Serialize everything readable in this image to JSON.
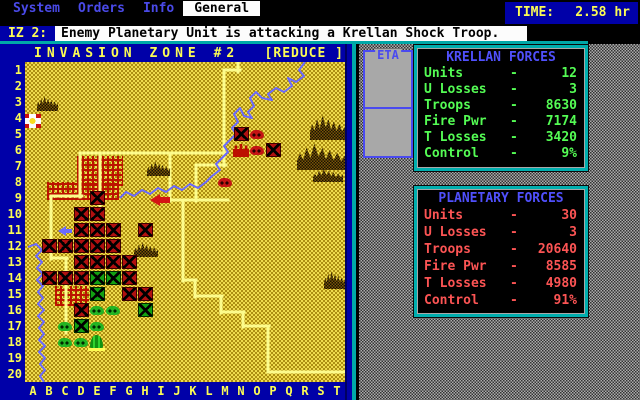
{
  "palette": {
    "blue": "#0000A8",
    "light_blue": "#5050FC",
    "teal": "#00A8A8",
    "yellow": "#FCFC54",
    "green": "#54FC54",
    "red": "#FC5454",
    "white": "#FCFCFC",
    "gray": "#A8A8A8"
  },
  "menu": {
    "items": [
      "System",
      "Orders",
      "Info",
      "General"
    ],
    "active": "General",
    "time_label": "TIME:",
    "time_value": "2.58 hr"
  },
  "message": {
    "prefix": "IZ 2:",
    "text": "Enemy Planetary Unit is attacking a Krellan Shock Troop."
  },
  "eta": {
    "label": "ETA"
  },
  "map": {
    "title": "INVASION ZONE #2",
    "reduce_button": "[REDUCE ]",
    "row_count": 20,
    "col_letters": "ABCDEFGHIJKLMNOPQRST",
    "features": {
      "cities": [
        [
          52,
          94,
          46,
          30
        ],
        [
          22,
          120,
          72,
          18
        ],
        [
          30,
          224,
          34,
          20
        ]
      ],
      "mountains": [
        [
          12,
          31,
          21,
          18
        ],
        [
          122,
          96,
          23,
          18
        ],
        [
          285,
          48,
          35,
          30
        ],
        [
          272,
          76,
          48,
          32
        ],
        [
          288,
          104,
          30,
          16
        ],
        [
          109,
          177,
          24,
          18
        ],
        [
          299,
          205,
          21,
          22
        ]
      ],
      "roads": [
        [
          213,
          0,
          213,
          10
        ],
        [
          199,
          8,
          215,
          8
        ],
        [
          199,
          8,
          199,
          104
        ],
        [
          55,
          91,
          201,
          91
        ],
        [
          145,
          91,
          145,
          139
        ],
        [
          171,
          103,
          201,
          103
        ],
        [
          171,
          103,
          171,
          139
        ],
        [
          135,
          138,
          203,
          138
        ],
        [
          158,
          138,
          158,
          219
        ],
        [
          55,
          91,
          55,
          135
        ],
        [
          75,
          91,
          75,
          144
        ],
        [
          27,
          134,
          57,
          134
        ],
        [
          26,
          134,
          26,
          197
        ],
        [
          26,
          196,
          42,
          196
        ],
        [
          41,
          196,
          41,
          271
        ],
        [
          158,
          218,
          171,
          218
        ],
        [
          170,
          218,
          170,
          235
        ],
        [
          170,
          234,
          197,
          234
        ],
        [
          196,
          234,
          196,
          251
        ],
        [
          196,
          250,
          219,
          250
        ],
        [
          218,
          250,
          218,
          265
        ],
        [
          218,
          264,
          244,
          264
        ],
        [
          243,
          264,
          243,
          310
        ],
        [
          243,
          310,
          320,
          310
        ]
      ],
      "rivers": [
        [
          [
            280,
            0
          ],
          [
            274,
            8
          ],
          [
            279,
            14
          ],
          [
            271,
            20
          ],
          [
            263,
            16
          ],
          [
            267,
            24
          ],
          [
            259,
            30
          ],
          [
            251,
            26
          ],
          [
            243,
            32
          ],
          [
            247,
            38
          ],
          [
            237,
            36
          ],
          [
            231,
            30
          ],
          [
            225,
            36
          ],
          [
            229,
            44
          ],
          [
            223,
            50
          ],
          [
            227,
            56
          ],
          [
            219,
            54
          ],
          [
            215,
            46
          ],
          [
            209,
            52
          ],
          [
            213,
            60
          ],
          [
            207,
            66
          ],
          [
            211,
            72
          ],
          [
            205,
            78
          ],
          [
            199,
            84
          ],
          [
            203,
            90
          ],
          [
            197,
            96
          ],
          [
            191,
            102
          ],
          [
            195,
            108
          ],
          [
            187,
            114
          ],
          [
            181,
            120
          ],
          [
            173,
            126
          ],
          [
            165,
            122
          ],
          [
            157,
            128
          ],
          [
            149,
            124
          ],
          [
            141,
            130
          ],
          [
            133,
            126
          ],
          [
            125,
            132
          ],
          [
            117,
            128
          ],
          [
            109,
            134
          ],
          [
            101,
            130
          ],
          [
            95,
            136
          ]
        ],
        [
          [
            3,
            185
          ],
          [
            11,
            182
          ],
          [
            17,
            188
          ],
          [
            11,
            194
          ],
          [
            17,
            200
          ],
          [
            12,
            206
          ],
          [
            18,
            212
          ],
          [
            12,
            218
          ],
          [
            18,
            224
          ],
          [
            13,
            230
          ],
          [
            18,
            236
          ],
          [
            13,
            242
          ],
          [
            19,
            248
          ],
          [
            13,
            254
          ],
          [
            19,
            260
          ],
          [
            14,
            266
          ],
          [
            19,
            272
          ],
          [
            14,
            278
          ],
          [
            20,
            284
          ],
          [
            14,
            290
          ],
          [
            20,
            296
          ],
          [
            15,
            302
          ],
          [
            20,
            308
          ],
          [
            15,
            314
          ],
          [
            19,
            320
          ]
        ]
      ],
      "units": [
        [
          "A",
          4,
          "flag"
        ],
        [
          "N",
          5,
          "red-square"
        ],
        [
          "O",
          5,
          "red-tank"
        ],
        [
          "N",
          6,
          "fort"
        ],
        [
          "O",
          6,
          "red-tank"
        ],
        [
          "P",
          6,
          "red-square"
        ],
        [
          "M",
          8,
          "red-tank"
        ],
        [
          "E",
          9,
          "red-square"
        ],
        [
          "I",
          9,
          "red-arrow"
        ],
        [
          "D",
          10,
          "red-square"
        ],
        [
          "E",
          10,
          "red-square"
        ],
        [
          "C",
          11,
          "blue-arrow"
        ],
        [
          "D",
          11,
          "red-square"
        ],
        [
          "E",
          11,
          "red-square"
        ],
        [
          "F",
          11,
          "red-square"
        ],
        [
          "H",
          11,
          "red-square"
        ],
        [
          "B",
          12,
          "red-square"
        ],
        [
          "C",
          12,
          "red-square"
        ],
        [
          "D",
          12,
          "red-square"
        ],
        [
          "E",
          12,
          "red-square"
        ],
        [
          "F",
          12,
          "red-square"
        ],
        [
          "D",
          13,
          "red-square"
        ],
        [
          "E",
          13,
          "red-square"
        ],
        [
          "F",
          13,
          "red-square"
        ],
        [
          "G",
          13,
          "red-square"
        ],
        [
          "B",
          14,
          "red-square"
        ],
        [
          "C",
          14,
          "red-square"
        ],
        [
          "D",
          14,
          "red-square"
        ],
        [
          "E",
          14,
          "green-square"
        ],
        [
          "F",
          14,
          "green-square"
        ],
        [
          "G",
          14,
          "red-square"
        ],
        [
          "E",
          15,
          "green-square"
        ],
        [
          "G",
          15,
          "red-square"
        ],
        [
          "H",
          15,
          "red-square"
        ],
        [
          "D",
          16,
          "red-square"
        ],
        [
          "E",
          16,
          "green-tank"
        ],
        [
          "F",
          16,
          "green-tank"
        ],
        [
          "H",
          16,
          "green-square"
        ],
        [
          "C",
          17,
          "green-tank"
        ],
        [
          "D",
          17,
          "green-square"
        ],
        [
          "E",
          17,
          "green-tank"
        ],
        [
          "C",
          18,
          "green-tank"
        ],
        [
          "D",
          18,
          "green-tank"
        ],
        [
          "E",
          18,
          "lander"
        ]
      ]
    }
  },
  "panels": [
    {
      "title": "KRELLAN FORCES",
      "color": "#54FC54",
      "rows": [
        {
          "label": "Units",
          "value": "12"
        },
        {
          "label": "U Losses",
          "value": "3"
        },
        {
          "label": "Troops",
          "value": "8630"
        },
        {
          "label": "Fire Pwr",
          "value": "7174"
        },
        {
          "label": "T Losses",
          "value": "3420"
        },
        {
          "label": "Control",
          "value": "9%"
        }
      ]
    },
    {
      "title": "PLANETARY FORCES",
      "color": "#FC5454",
      "rows": [
        {
          "label": "Units",
          "value": "30"
        },
        {
          "label": "U Losses",
          "value": "3"
        },
        {
          "label": "Troops",
          "value": "20640"
        },
        {
          "label": "Fire Pwr",
          "value": "8585"
        },
        {
          "label": "T Losses",
          "value": "4980"
        },
        {
          "label": "Control",
          "value": "91%"
        }
      ]
    }
  ]
}
